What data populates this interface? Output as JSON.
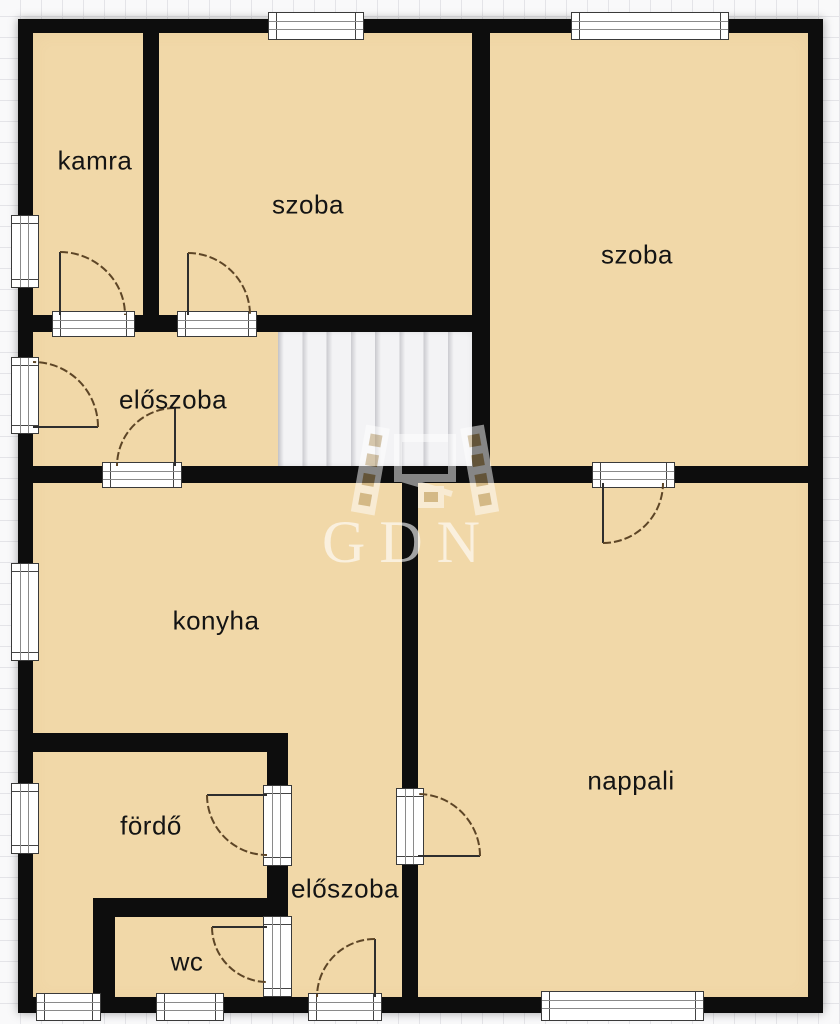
{
  "plan": {
    "rooms": [
      {
        "id": "kamra",
        "label": "kamra"
      },
      {
        "id": "szoba-small",
        "label": "szoba"
      },
      {
        "id": "szoba-large",
        "label": "szoba"
      },
      {
        "id": "eloszoba-upper",
        "label": "előszoba"
      },
      {
        "id": "konyha",
        "label": "konyha"
      },
      {
        "id": "nappali",
        "label": "nappali"
      },
      {
        "id": "fordo",
        "label": "fördő"
      },
      {
        "id": "eloszoba-lower",
        "label": "előszoba"
      },
      {
        "id": "wc",
        "label": "wc"
      }
    ],
    "watermark": {
      "text": "GDN"
    },
    "colors": {
      "room_fill": "#f1d8a8",
      "wall": "#0d0d0d",
      "background": "#f9f9fa",
      "stairs": "#f1f1f4",
      "door_arc": "#5d4526"
    }
  }
}
